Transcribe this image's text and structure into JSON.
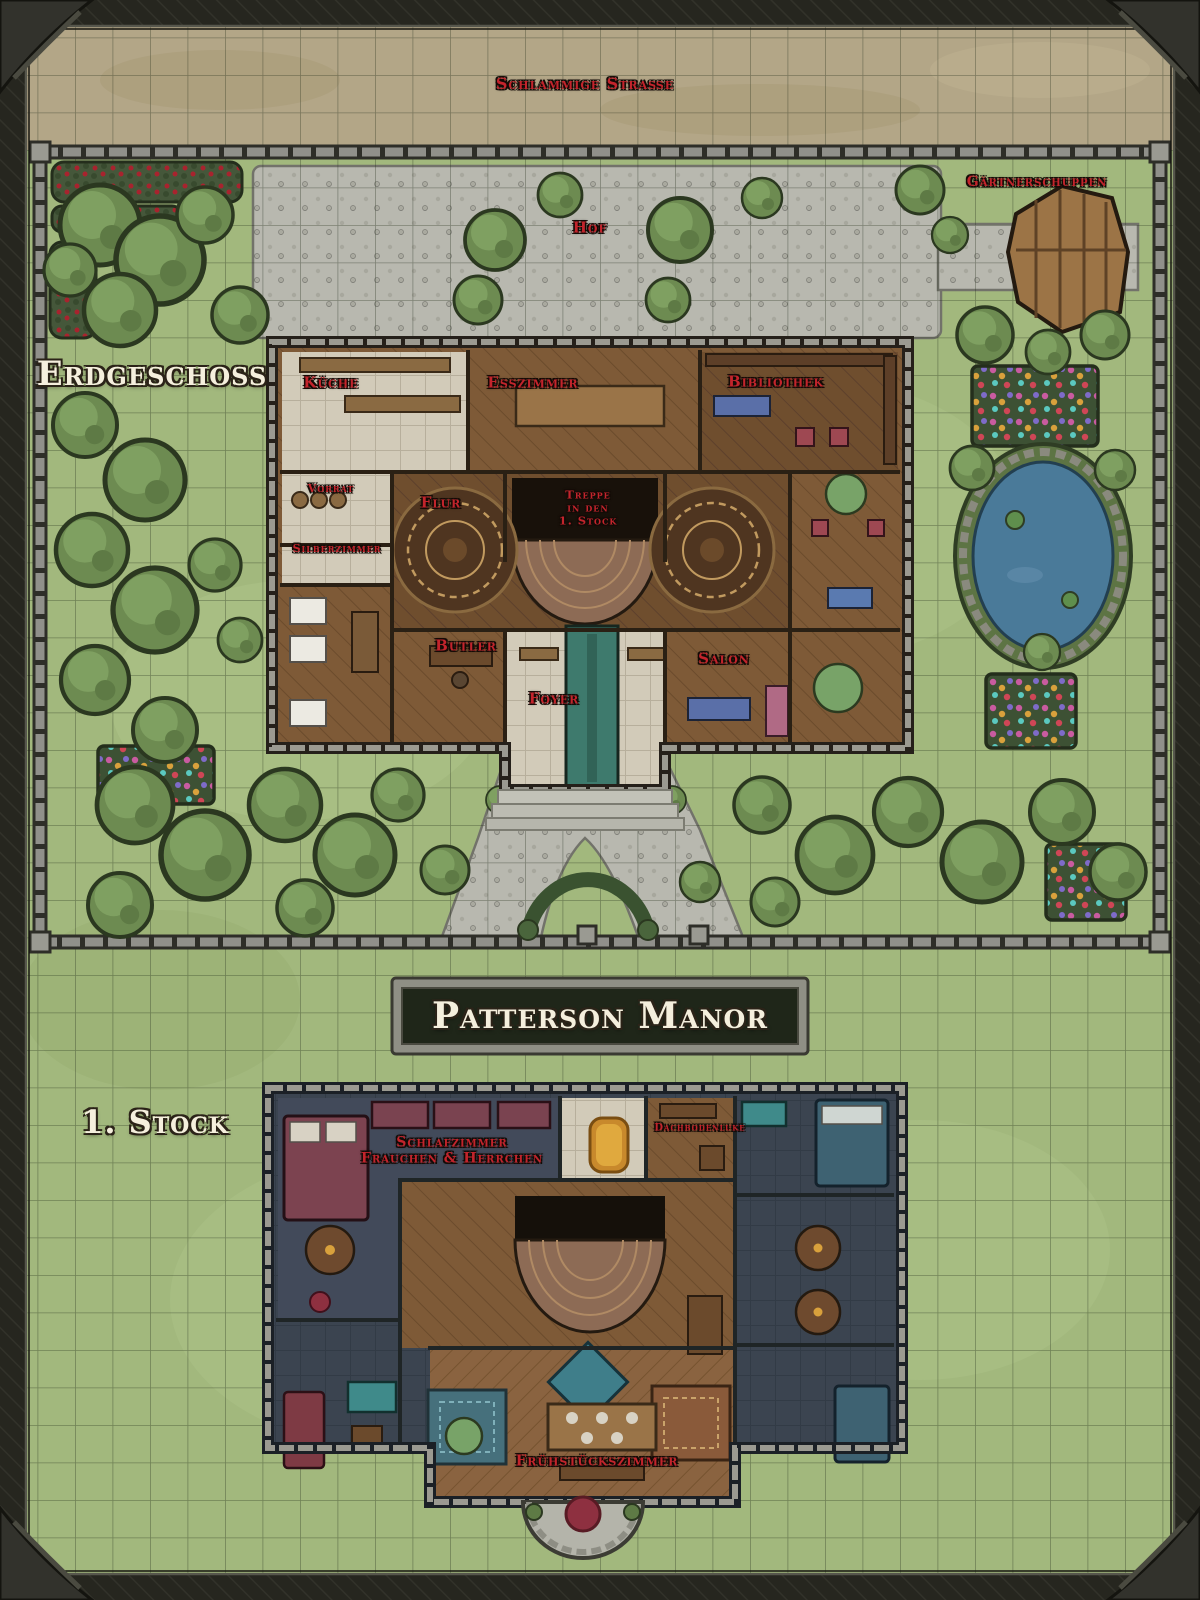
{
  "map": {
    "title": "Patterson Manor",
    "outdoor": {
      "road": "Schlammige Straße",
      "courtyard": "Hof",
      "shed": "Gärtnerschuppen"
    },
    "floors": {
      "ground": {
        "label": "Erdgeschoss",
        "rooms": {
          "kueche": "Küche",
          "esszimmer": "Esszimmer",
          "bibliothek": "Bibliothek",
          "vorrat": "Vorrat",
          "silberzimmer": "Silberzimmer",
          "flur": "Flur",
          "treppe": "Treppe\nin den\n1. Stock",
          "butler": "Butler",
          "foyer": "Foyer",
          "salon": "Salon"
        }
      },
      "first": {
        "label": "1. Stock",
        "rooms": {
          "schlafzimmer": "Schlafzimmer\nFrauchen & Herrchen",
          "dachbodenluke": "Dachbodenluke",
          "fruehstueckszimmer": "Frühstückszimmer"
        }
      }
    },
    "palette": {
      "label_red": "#c3242c",
      "label_white": "#f5efdd",
      "grass": "#a2b87d",
      "dirt": "#b3a687",
      "cobblestone": "#b9b9b0",
      "wood_floor": "#7e5a37",
      "slate_floor": "#3b4450",
      "water": "#4a7a99",
      "plaque_bg": "#1f2619"
    }
  }
}
